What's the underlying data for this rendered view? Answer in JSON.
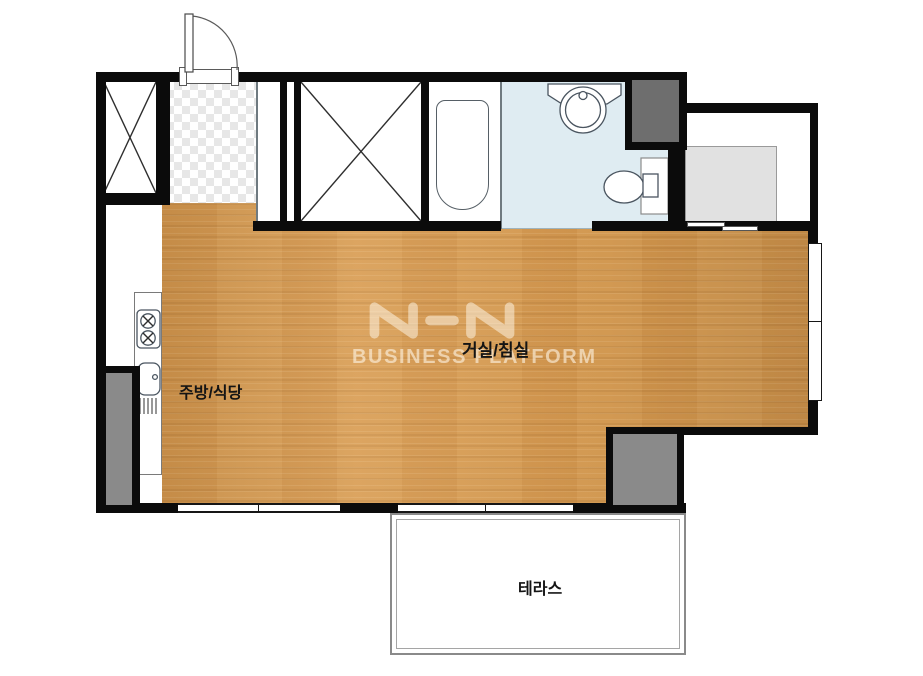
{
  "title": "studio apartment floor plan",
  "labels": {
    "living_room": "거실/침실",
    "kitchen": "주방/식당",
    "terrace": "테라스"
  },
  "watermark": {
    "logo": "NHN",
    "subtitle": "BUSINESS PLATFORM"
  },
  "colors": {
    "wall": "#0b0b0b",
    "wood_floor": "#d79a50",
    "bathroom_floor": "#dfecf2",
    "entry_tile": "#e7e7e7",
    "column_dark": "#6e6e6e",
    "column_light": "#8a8a8a",
    "appliance_gray": "#e1e1e1",
    "line_gray": "#8a8a8a",
    "fixture_stroke": "#4a5560"
  },
  "fixtures": {
    "entrance_door": "swing-door",
    "wardrobe_left": "closet-x",
    "wardrobe_main": "closet-x",
    "bathtub": "bathtub",
    "washbasin": "round-basin-with-faucet",
    "toilet": "toilet-side-view",
    "washer_area": "utility-gray-box",
    "stove": "two-burner-stove",
    "kitchen_sink": "sink-with-drainboard",
    "sliding_door": "two-panel-slider"
  }
}
